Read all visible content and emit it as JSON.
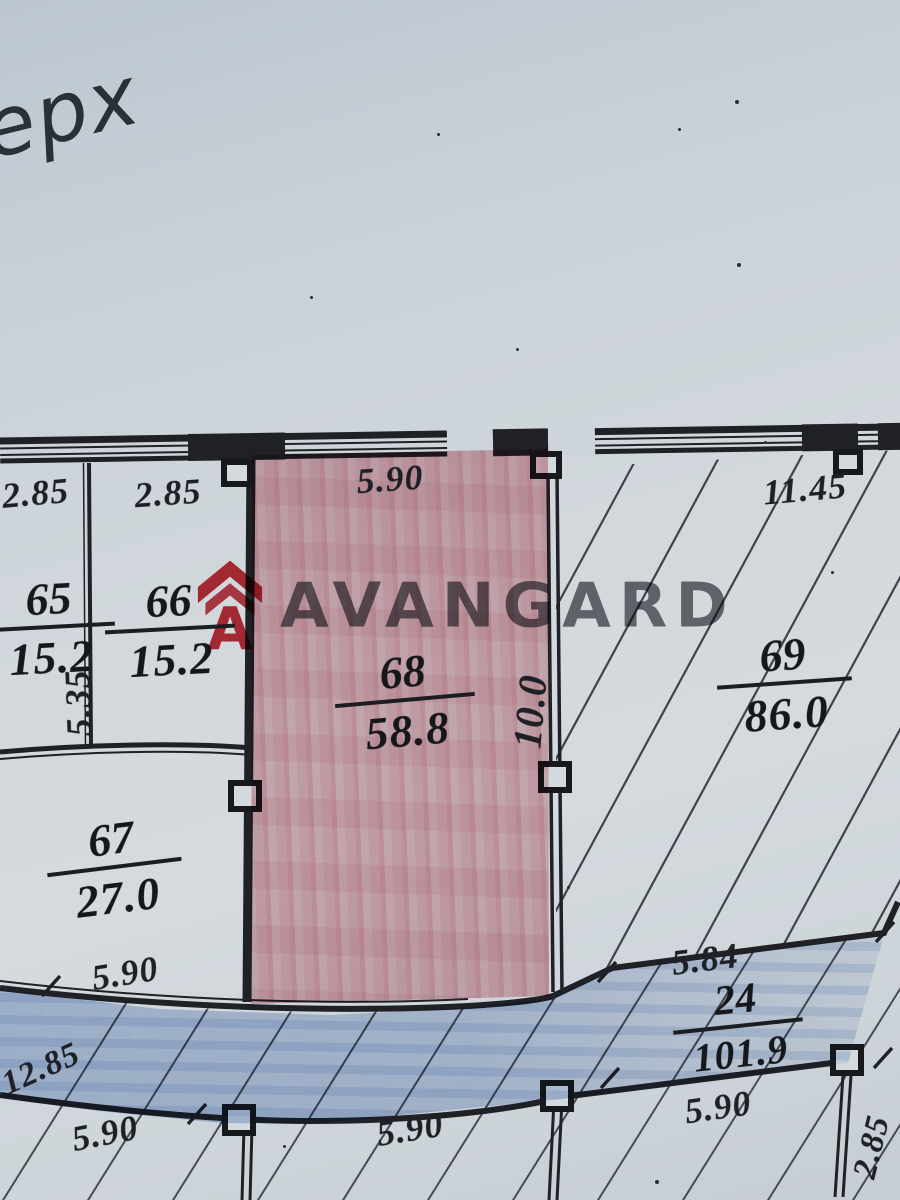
{
  "labels": {
    "handwriting": "ерх",
    "logo_text": "AVANGARD"
  },
  "rooms": [
    {
      "number": "65",
      "area": "15.2",
      "loc": "top-left-room"
    },
    {
      "number": "66",
      "area": "15.2",
      "loc": "top-second-room"
    },
    {
      "number": "67",
      "area": "27.0",
      "loc": "left-lower-room"
    },
    {
      "number": "68",
      "area": "58.8",
      "loc": "center-room-red-highlight"
    },
    {
      "number": "69",
      "area": "86.0",
      "loc": "right-large-room-hatched"
    },
    {
      "number": "24",
      "area": "101.9",
      "loc": "bottom-corridor-blue-highlight"
    }
  ],
  "dims": [
    {
      "value": "2.85",
      "loc": "top-wall-room-65"
    },
    {
      "value": "2.85",
      "loc": "top-wall-room-66"
    },
    {
      "value": "5.90",
      "loc": "top-wall-room-68"
    },
    {
      "value": "11.45",
      "loc": "top-wall-room-69"
    },
    {
      "value": "5.35",
      "loc": "left-wall-vertical"
    },
    {
      "value": "10.0",
      "loc": "wall-68-69-vertical"
    },
    {
      "value": "5.90",
      "loc": "room-67-bottom"
    },
    {
      "value": "5.84",
      "loc": "above-corridor-right"
    },
    {
      "value": "12.85",
      "loc": "corridor-left-edge"
    },
    {
      "value": "5.90",
      "loc": "bottom-left"
    },
    {
      "value": "5.90",
      "loc": "bottom-center"
    },
    {
      "value": "5.90",
      "loc": "bottom-right-under-24"
    },
    {
      "value": "2.85",
      "loc": "bottom-right-vertical"
    }
  ],
  "colors": {
    "paper": "#cdd4da",
    "ink": "#1f2126",
    "room68_highlight": "#e4b0b8",
    "corridor24_highlight": "#8ea8d2",
    "logo_red": "#c62f39",
    "logo_gray": "#54565c"
  }
}
